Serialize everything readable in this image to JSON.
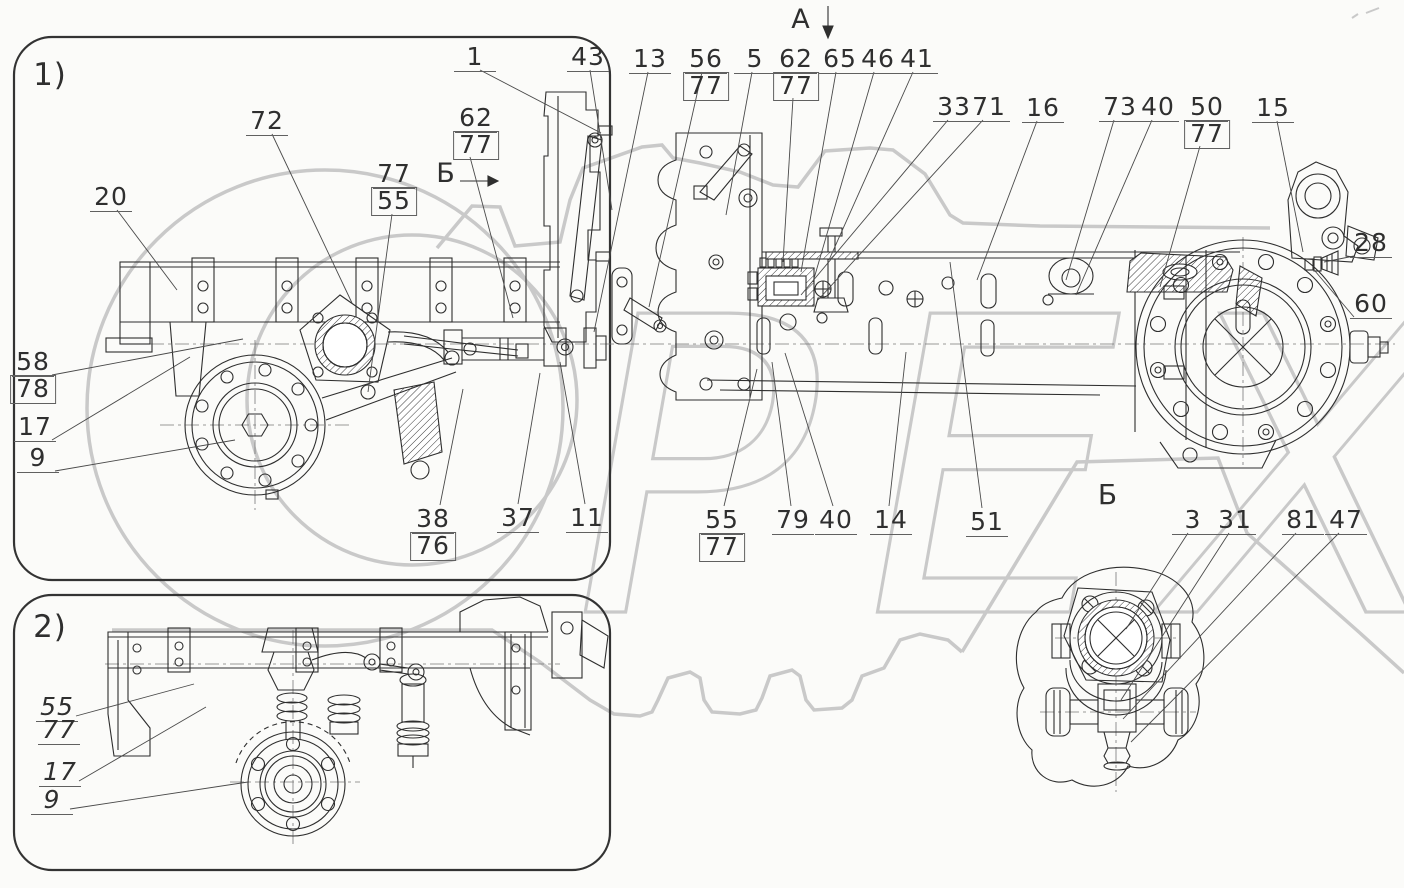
{
  "watermark": {
    "text": "РЕХ",
    "color": "#c9c9c9"
  },
  "views": {
    "view1_label": "1)",
    "view2_label": "2)"
  },
  "section_marks": {
    "arrow_view_a": "А",
    "arrow_view_b": "Б",
    "detail_view_b": "Б"
  },
  "callouts": [
    {
      "id": "v1",
      "text": "1)",
      "x": 50,
      "y": 60,
      "plain": true,
      "size": 31
    },
    {
      "id": "v2",
      "text": "2)",
      "x": 50,
      "y": 612,
      "plain": true,
      "size": 31
    },
    {
      "id": "secA",
      "text": "А",
      "x": 801,
      "y": 6,
      "plain": true,
      "size": 27
    },
    {
      "id": "secB-left",
      "text": "Б",
      "x": 446,
      "y": 160,
      "plain": true,
      "size": 27
    },
    {
      "id": "secB-view",
      "text": "Б",
      "x": 1108,
      "y": 481,
      "plain": true,
      "size": 28
    },
    {
      "id": "c1",
      "text": "1",
      "x": 475,
      "y": 44,
      "underline": true,
      "leader": [
        [
          480,
          70
        ],
        [
          601,
          133
        ]
      ]
    },
    {
      "id": "c43",
      "text": "43",
      "x": 588,
      "y": 44,
      "underline": true,
      "leader": [
        [
          590,
          70
        ],
        [
          612,
          210
        ]
      ]
    },
    {
      "id": "c13",
      "text": "13",
      "x": 650,
      "y": 46,
      "underline": true,
      "leader": [
        [
          648,
          72
        ],
        [
          594,
          332
        ]
      ]
    },
    {
      "id": "c56",
      "text": "56",
      "x": 706,
      "y": 46,
      "underline": true,
      "leader": [
        [
          702,
          72
        ],
        [
          649,
          307
        ]
      ]
    },
    {
      "id": "c56b",
      "text": "77",
      "x": 706,
      "y": 72,
      "boxed": true
    },
    {
      "id": "c5",
      "text": "5",
      "x": 755,
      "y": 46,
      "underline": true,
      "leader": [
        [
          752,
          72
        ],
        [
          726,
          215
        ]
      ]
    },
    {
      "id": "c62t",
      "text": "62",
      "x": 796,
      "y": 46,
      "underline": true,
      "leader": [
        [
          793,
          98
        ],
        [
          783,
          262
        ]
      ]
    },
    {
      "id": "c62tb",
      "text": "77",
      "x": 796,
      "y": 72,
      "boxed": true
    },
    {
      "id": "c65",
      "text": "65",
      "x": 840,
      "y": 46,
      "underline": true,
      "leader": [
        [
          836,
          72
        ],
        [
          801,
          272
        ]
      ]
    },
    {
      "id": "c46",
      "text": "46",
      "x": 878,
      "y": 46,
      "underline": true,
      "leader": [
        [
          874,
          72
        ],
        [
          813,
          282
        ]
      ]
    },
    {
      "id": "c41",
      "text": "41",
      "x": 917,
      "y": 46,
      "underline": true,
      "leader": [
        [
          913,
          72
        ],
        [
          829,
          260
        ]
      ]
    },
    {
      "id": "c33",
      "text": "33",
      "x": 954,
      "y": 94,
      "underline": true,
      "leader": [
        [
          948,
          120
        ],
        [
          801,
          295
        ]
      ]
    },
    {
      "id": "c71",
      "text": "71",
      "x": 989,
      "y": 94,
      "underline": true,
      "leader": [
        [
          983,
          120
        ],
        [
          818,
          300
        ]
      ]
    },
    {
      "id": "c16",
      "text": "16",
      "x": 1043,
      "y": 95,
      "underline": true,
      "leader": [
        [
          1037,
          121
        ],
        [
          977,
          280
        ]
      ]
    },
    {
      "id": "c73",
      "text": "73",
      "x": 1120,
      "y": 94,
      "underline": true,
      "leader": [
        [
          1114,
          120
        ],
        [
          1066,
          280
        ]
      ]
    },
    {
      "id": "c40t",
      "text": "40",
      "x": 1158,
      "y": 94,
      "underline": true,
      "leader": [
        [
          1152,
          120
        ],
        [
          1076,
          295
        ]
      ]
    },
    {
      "id": "c50",
      "text": "50",
      "x": 1207,
      "y": 94,
      "underline": true,
      "leader": [
        [
          1200,
          146
        ],
        [
          1160,
          287
        ]
      ]
    },
    {
      "id": "c50b",
      "text": "77",
      "x": 1207,
      "y": 120,
      "boxed": true
    },
    {
      "id": "c15",
      "text": "15",
      "x": 1273,
      "y": 95,
      "underline": true,
      "leader": [
        [
          1277,
          121
        ],
        [
          1303,
          252
        ]
      ]
    },
    {
      "id": "c28",
      "text": "28",
      "x": 1371,
      "y": 230,
      "underline": true,
      "leader": [
        [
          1354,
          256
        ],
        [
          1324,
          262
        ]
      ]
    },
    {
      "id": "c60",
      "text": "60",
      "x": 1371,
      "y": 291,
      "underline": true,
      "leader": [
        [
          1354,
          317
        ],
        [
          1315,
          271
        ]
      ]
    },
    {
      "id": "c72",
      "text": "72",
      "x": 267,
      "y": 108,
      "underline": true,
      "leader": [
        [
          272,
          134
        ],
        [
          352,
          303
        ]
      ]
    },
    {
      "id": "c62l",
      "text": "62",
      "x": 476,
      "y": 105,
      "underline": true,
      "leader": [
        [
          470,
          157
        ],
        [
          513,
          318
        ]
      ]
    },
    {
      "id": "c62lb",
      "text": "77",
      "x": 476,
      "y": 131,
      "boxed": true
    },
    {
      "id": "c77l",
      "text": "77",
      "x": 394,
      "y": 161,
      "underline": true,
      "leader": [
        [
          392,
          214
        ],
        [
          368,
          392
        ]
      ]
    },
    {
      "id": "c77lb",
      "text": "55",
      "x": 394,
      "y": 187,
      "boxed": true
    },
    {
      "id": "c20",
      "text": "20",
      "x": 111,
      "y": 184,
      "underline": true,
      "leader": [
        [
          117,
          210
        ],
        [
          177,
          290
        ]
      ]
    },
    {
      "id": "c58",
      "text": "58",
      "x": 33,
      "y": 349,
      "underline": true,
      "leader": [
        [
          52,
          375
        ],
        [
          243,
          339
        ]
      ]
    },
    {
      "id": "c58b",
      "text": "78",
      "x": 33,
      "y": 375,
      "boxed": true
    },
    {
      "id": "c17",
      "text": "17",
      "x": 35,
      "y": 414,
      "underline": true,
      "leader": [
        [
          52,
          440
        ],
        [
          190,
          357
        ]
      ]
    },
    {
      "id": "c9",
      "text": "9",
      "x": 38,
      "y": 445,
      "underline": true,
      "leader": [
        [
          55,
          471
        ],
        [
          235,
          440
        ]
      ]
    },
    {
      "id": "c38",
      "text": "38",
      "x": 433,
      "y": 506,
      "underline": true,
      "leader": [
        [
          440,
          505
        ],
        [
          463,
          389
        ]
      ]
    },
    {
      "id": "c38b",
      "text": "76",
      "x": 433,
      "y": 532,
      "boxed": true
    },
    {
      "id": "c37",
      "text": "37",
      "x": 518,
      "y": 505,
      "underline": true,
      "leader": [
        [
          518,
          504
        ],
        [
          540,
          373
        ]
      ]
    },
    {
      "id": "c11",
      "text": "11",
      "x": 587,
      "y": 505,
      "underline": true,
      "leader": [
        [
          585,
          504
        ],
        [
          560,
          362
        ]
      ]
    },
    {
      "id": "c55m",
      "text": "55",
      "x": 722,
      "y": 507,
      "underline": true,
      "leader": [
        [
          724,
          506
        ],
        [
          757,
          369
        ]
      ]
    },
    {
      "id": "c55mb",
      "text": "77",
      "x": 722,
      "y": 533,
      "boxed": true
    },
    {
      "id": "c79",
      "text": "79",
      "x": 793,
      "y": 507,
      "underline": true,
      "leader": [
        [
          791,
          506
        ],
        [
          772,
          362
        ]
      ]
    },
    {
      "id": "c40b",
      "text": "40",
      "x": 836,
      "y": 507,
      "underline": true,
      "leader": [
        [
          833,
          506
        ],
        [
          785,
          353
        ]
      ]
    },
    {
      "id": "c14",
      "text": "14",
      "x": 891,
      "y": 507,
      "underline": true,
      "leader": [
        [
          889,
          506
        ],
        [
          906,
          352
        ]
      ]
    },
    {
      "id": "c51",
      "text": "51",
      "x": 987,
      "y": 509,
      "underline": true,
      "leader": [
        [
          982,
          508
        ],
        [
          950,
          262
        ]
      ]
    },
    {
      "id": "c3",
      "text": "3",
      "x": 1193,
      "y": 507,
      "underline": true,
      "leader": [
        [
          1188,
          533
        ],
        [
          1126,
          629
        ]
      ]
    },
    {
      "id": "c31",
      "text": "31",
      "x": 1235,
      "y": 507,
      "underline": true,
      "leader": [
        [
          1229,
          533
        ],
        [
          1121,
          700
        ]
      ]
    },
    {
      "id": "c81",
      "text": "81",
      "x": 1303,
      "y": 507,
      "underline": true,
      "leader": [
        [
          1296,
          533
        ],
        [
          1123,
          719
        ]
      ]
    },
    {
      "id": "c47",
      "text": "47",
      "x": 1346,
      "y": 507,
      "underline": true,
      "leader": [
        [
          1339,
          533
        ],
        [
          1131,
          742
        ]
      ]
    },
    {
      "id": "c55i",
      "text": "55",
      "x": 57,
      "y": 694,
      "underline": true,
      "italic": true,
      "leader": [
        [
          76,
          716
        ],
        [
          194,
          684
        ]
      ]
    },
    {
      "id": "c77i",
      "text": "77",
      "x": 59,
      "y": 717,
      "underline": true,
      "italic": true
    },
    {
      "id": "c17i",
      "text": "17",
      "x": 60,
      "y": 759,
      "underline": true,
      "italic": true,
      "leader": [
        [
          79,
          781
        ],
        [
          206,
          707
        ]
      ]
    },
    {
      "id": "c9i",
      "text": "9",
      "x": 52,
      "y": 787,
      "underline": true,
      "italic": true,
      "leader": [
        [
          70,
          809
        ],
        [
          248,
          782
        ]
      ]
    }
  ]
}
